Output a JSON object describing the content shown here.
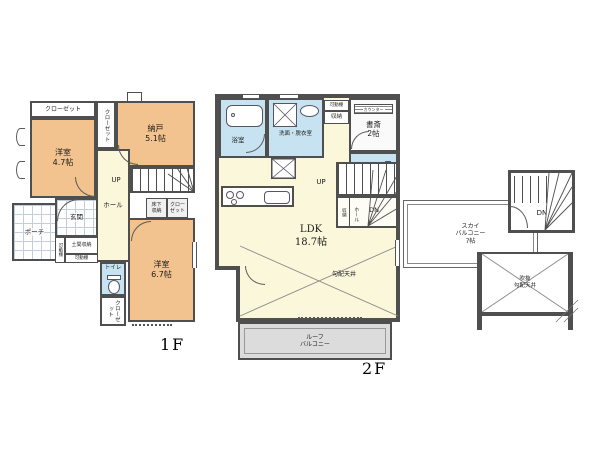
{
  "f1": {
    "floor_label": "1F",
    "closet_top": "クローゼット",
    "closet_side": "クローゼット",
    "room47": "洋室\n4.7帖",
    "nando": "納戸\n5.1帖",
    "up": "UP",
    "hall": "ホール",
    "underfloor": "床下\n収納",
    "closet_mid": "クロー\nゼット",
    "room67": "洋室\n6.7帖",
    "toilet": "トイレ",
    "closet_bottom": "クローゼット",
    "porch": "ポーチ",
    "genkan": "玄関",
    "shelf_left": "可動棚",
    "doma": "土間収納",
    "shelf_bottom": "可動棚"
  },
  "f2": {
    "floor_label": "2F",
    "bath": "浴室",
    "washroom": "洗面・脱衣室",
    "shelf": "可動棚",
    "storage_top": "収納",
    "counter": "カウンター",
    "study": "書斎\n2帖",
    "toilet": "トイレ",
    "up": "UP",
    "dn": "DN",
    "storage_stairs": "収納",
    "hall": "ホール",
    "ldk": "LDK\n18.7帖",
    "sloped_ceiling": "勾配天井",
    "roof_balcony": "ルーフ\nバルコニー"
  },
  "sky": {
    "balcony": "スカイ\nバルコニー\n7帖",
    "dn": "DN",
    "void": "吹抜\n勾配天井"
  },
  "colors": {
    "room_orange": "#f2c38e",
    "hall_yellow": "#fbf7da",
    "wet_blue": "#c7e3f1",
    "balcony_gray": "#dcdcdc",
    "tile_line": "#c3cedb",
    "wall": "#4f4f4f"
  }
}
